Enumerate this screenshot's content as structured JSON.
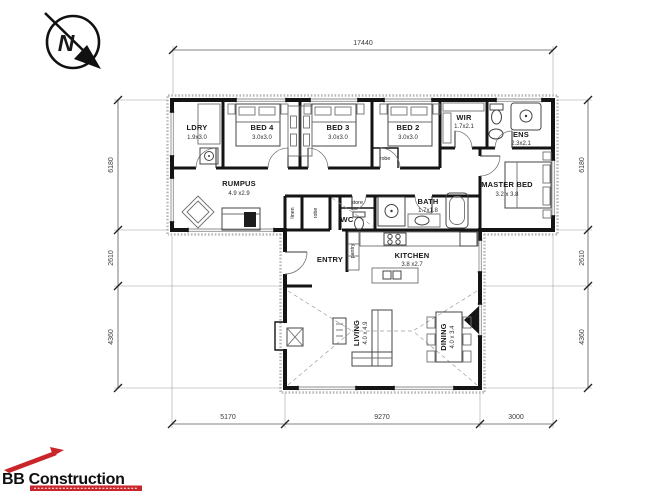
{
  "compass": {
    "label": "N"
  },
  "dims": {
    "top": "17440",
    "bottom": [
      "5170",
      "9270",
      "3000"
    ],
    "left": [
      "6180",
      "2610",
      "4360"
    ],
    "right": [
      "6180",
      "2610",
      "4360"
    ]
  },
  "rooms": {
    "ldry": {
      "name": "LDRY",
      "size": "1.9x3.0"
    },
    "bed4": {
      "name": "BED 4",
      "size": "3.0x3.0"
    },
    "bed3": {
      "name": "BED 3",
      "size": "3.0x3.0"
    },
    "bed2": {
      "name": "BED 2",
      "size": "3.0x3.0"
    },
    "wir": {
      "name": "WIR",
      "size": "1.7x2.1"
    },
    "ens": {
      "name": "ENS",
      "size": "2.3x2.1"
    },
    "master": {
      "name": "MASTER BED",
      "size": "3.2 x 3.8"
    },
    "rumpus": {
      "name": "RUMPUS",
      "size": "4.9 x2.9"
    },
    "bath": {
      "name": "BATH",
      "size": "1.7x1.8"
    },
    "wc": {
      "name": "WC"
    },
    "store": {
      "name": "store"
    },
    "robe": {
      "name": "robe"
    },
    "linen": {
      "name": "linen"
    },
    "pantry": {
      "name": "pantry"
    },
    "entry": {
      "name": "ENTRY"
    },
    "kitchen": {
      "name": "KITCHEN",
      "size": "3.8 x2.7"
    },
    "living": {
      "name": "LIVING",
      "size": "4.0 x 4.9"
    },
    "dining": {
      "name": "DINING",
      "size": "4.0 x 3.4"
    }
  },
  "logo": {
    "brand": "BB Construction"
  },
  "colors": {
    "accent_red": "#c9252b",
    "wall": "#141414"
  }
}
